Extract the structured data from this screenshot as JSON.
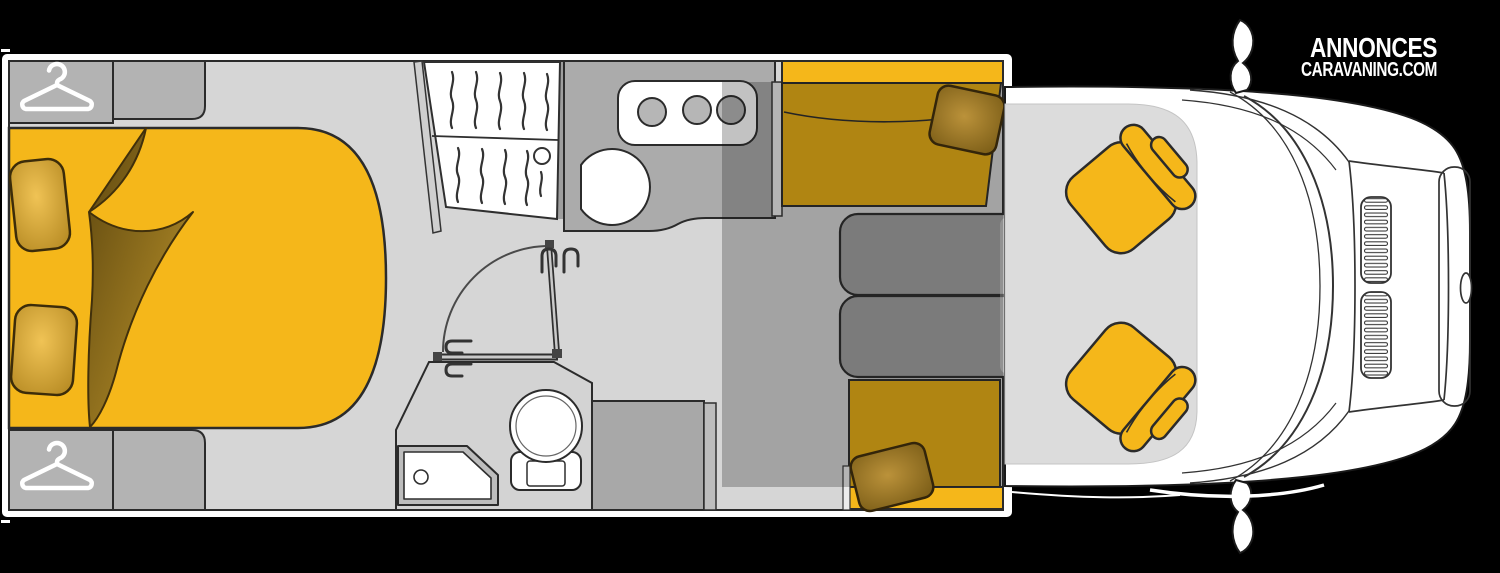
{
  "brand": {
    "line1": "ANNONCES",
    "line2": "CARAVANING.COM"
  },
  "colors": {
    "background": "#000000",
    "body": "#ffffff",
    "outline": "#2b2b2b",
    "floor": "#d6d6d6",
    "cabinet": "#b3b3b3",
    "counter": "#ababab",
    "table": "#9f9f9f",
    "accent": "#f5b71a",
    "seat": "#e7ad12",
    "cab_floor": "#dcdcdc"
  },
  "floorplan": {
    "view": "top-down-motorhome-layout",
    "zones": [
      {
        "name": "rear-bedroom",
        "items": [
          "wardrobe-hanger",
          "wardrobe-hanger",
          "island-bed",
          "pillow",
          "pillow",
          "folded-blanket"
        ]
      },
      {
        "name": "mid-cabin",
        "items": [
          "hanging-closet",
          "hob-3-burners",
          "round-sink",
          "swing-door",
          "shower-tray",
          "toilet",
          "cabinet"
        ]
      },
      {
        "name": "lounge",
        "items": [
          "bench-seat",
          "bench-seat",
          "folding-table",
          "cushion",
          "cushion",
          "drop-down-bed-overlay"
        ]
      },
      {
        "name": "cab",
        "items": [
          "swivel-seat",
          "swivel-seat",
          "windshield",
          "hood-grille",
          "wing-mirror",
          "wing-mirror"
        ]
      }
    ]
  }
}
